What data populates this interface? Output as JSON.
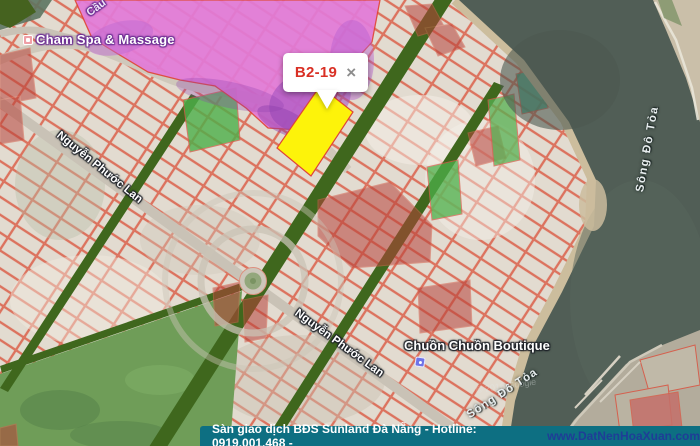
{
  "map": {
    "popup": {
      "title": "B2-19",
      "close": "×"
    },
    "labels": {
      "bridge": "Cầu",
      "spa": "Cham Spa & Massage",
      "street1": "Nguyễn Phước Lan",
      "street2": "Nguyễn Phước Lan",
      "boutique": "Chuồn Chuồn Boutique",
      "river1": "Sông Đô Tỏa",
      "river2": "Sông Đô Tỏa",
      "watermark": "© 2016 Google"
    },
    "selected_parcel_id": "B2-19"
  },
  "footer": {
    "text": "Sàn giao dịch BĐS Sunland Đà Nẵng - Hotline: 0919.001.468 -",
    "link": "www.DatNenHoaXuan.com"
  },
  "colors": {
    "parcel_highlight_yellow": "#FDF30A",
    "popup_title_red": "#D93025",
    "footer_background_teal": "#0D6F82",
    "footer_link_blue": "#1F3D97",
    "planning_zone_pink": "#E27AD8",
    "greenway_dark_green": "#3F671D",
    "parcel_outline_red": "#DC6A55",
    "river_gray_green": "#515E56"
  }
}
